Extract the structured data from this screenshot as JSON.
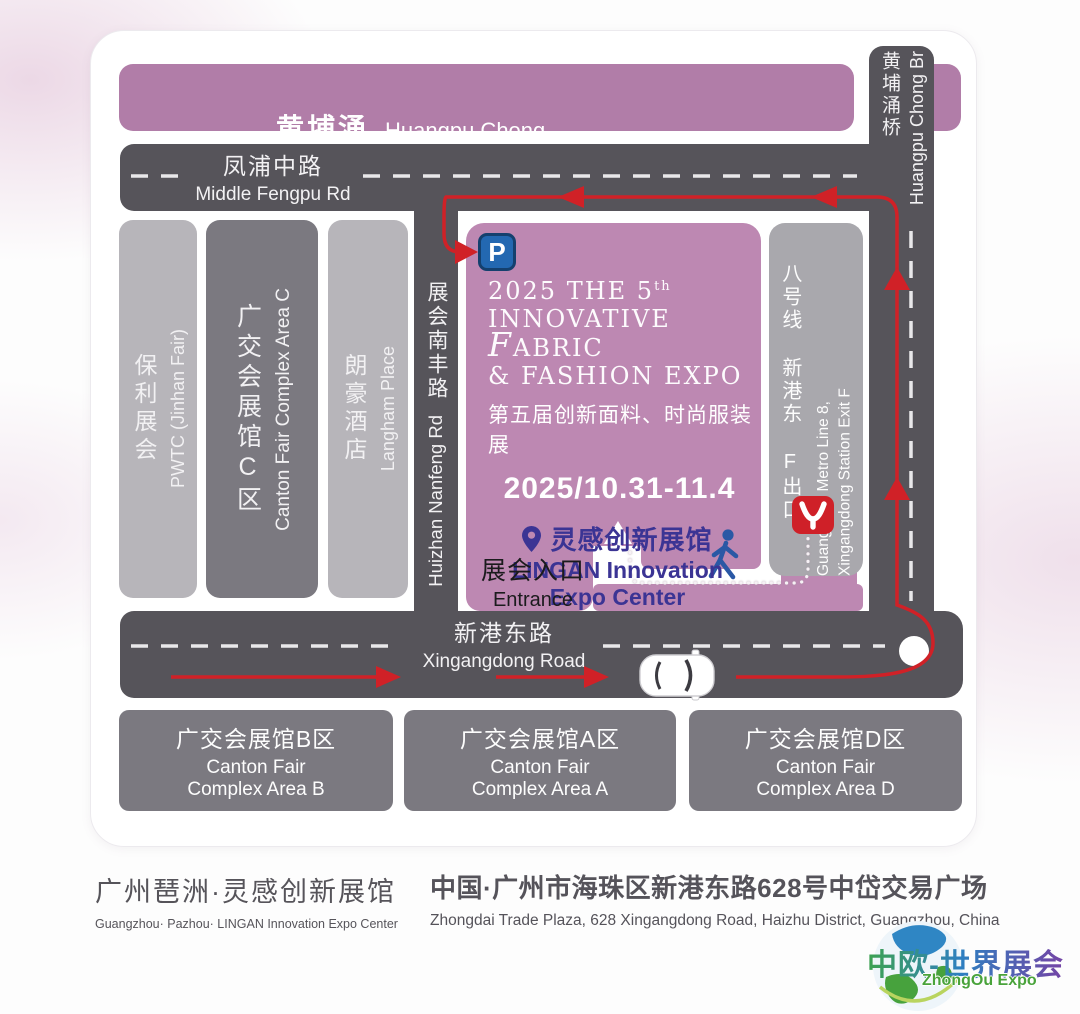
{
  "colors": {
    "road": "#56545a",
    "river": "#b17da8",
    "venue_purple": "#bd88b2",
    "building_light": "#b7b5ba",
    "building_dark": "#7b7980",
    "metro_gray": "#a9a8ad",
    "route_red": "#d02127",
    "parking_blue": "#2368b1",
    "metro_logo_red": "#cf2028",
    "venue_text_indigo": "#3b3494"
  },
  "map": {
    "river": {
      "zh": "黄埔涌",
      "en": "Huangpu Chong"
    },
    "bridge": {
      "zh": "黄埔涌桥",
      "en": "Huangpu Chong Br"
    },
    "fengpu": {
      "zh": "凤浦中路",
      "en": "Middle Fengpu Rd"
    },
    "xingang": {
      "zh": "新港东路",
      "en": "Xingangdong Road"
    },
    "nanfeng": {
      "zh": "展会南丰路",
      "en": "Huizhan Nanfeng Rd"
    },
    "pwtc": {
      "zh": "保利展会",
      "en": "PWTC (Jinhan Fair)"
    },
    "area_c": {
      "zh": "广交会展馆C区",
      "en": "Canton Fair Complex Area C"
    },
    "langham": {
      "zh": "朗豪酒店",
      "en": "Langham Place"
    },
    "area_b": {
      "zh": "广交会展馆B区",
      "en1": "Canton Fair",
      "en2": "Complex Area B"
    },
    "area_a": {
      "zh": "广交会展馆A区",
      "en1": "Canton Fair",
      "en2": "Complex Area A"
    },
    "area_d": {
      "zh": "广交会展馆D区",
      "en1": "Canton Fair",
      "en2": "Complex Area D"
    },
    "metro": {
      "zh": "八号线 新港东 F出口",
      "en1": "Guangzhou Metro Line 8,",
      "en2": "Xingangdong Station Exit F"
    },
    "entrance": {
      "zh": "展会入口",
      "en": "Entrance"
    },
    "parking": "P",
    "expo": {
      "line1": "2025 THE 5",
      "line1_sup": "th",
      "line2_pre": "INNOVATIVE ",
      "line2_f": "F",
      "line2_rest": "ABRIC",
      "line3": "& FASHION  EXPO",
      "subtitle": "第五届创新面料、时尚服装展",
      "dates": "2025/10.31-11.4",
      "venue_zh": "灵感创新展馆",
      "venue_en1": "LINGAN Innovation",
      "venue_en2": "Expo Center"
    }
  },
  "footer": {
    "left_zh": "广州琶洲·灵感创新展馆",
    "left_en": "Guangzhou· Pazhou· LINGAN Innovation Expo Center",
    "right_zh": "中国·广州市海珠区新港东路628号中岱交易广场",
    "right_en": "Zhongdai Trade Plaza, 628 Xingangdong Road, Haizhu District, Guangzhou, China",
    "logo_zh": "中欧-世界展会",
    "logo_en": "ZhongOu Expo"
  }
}
